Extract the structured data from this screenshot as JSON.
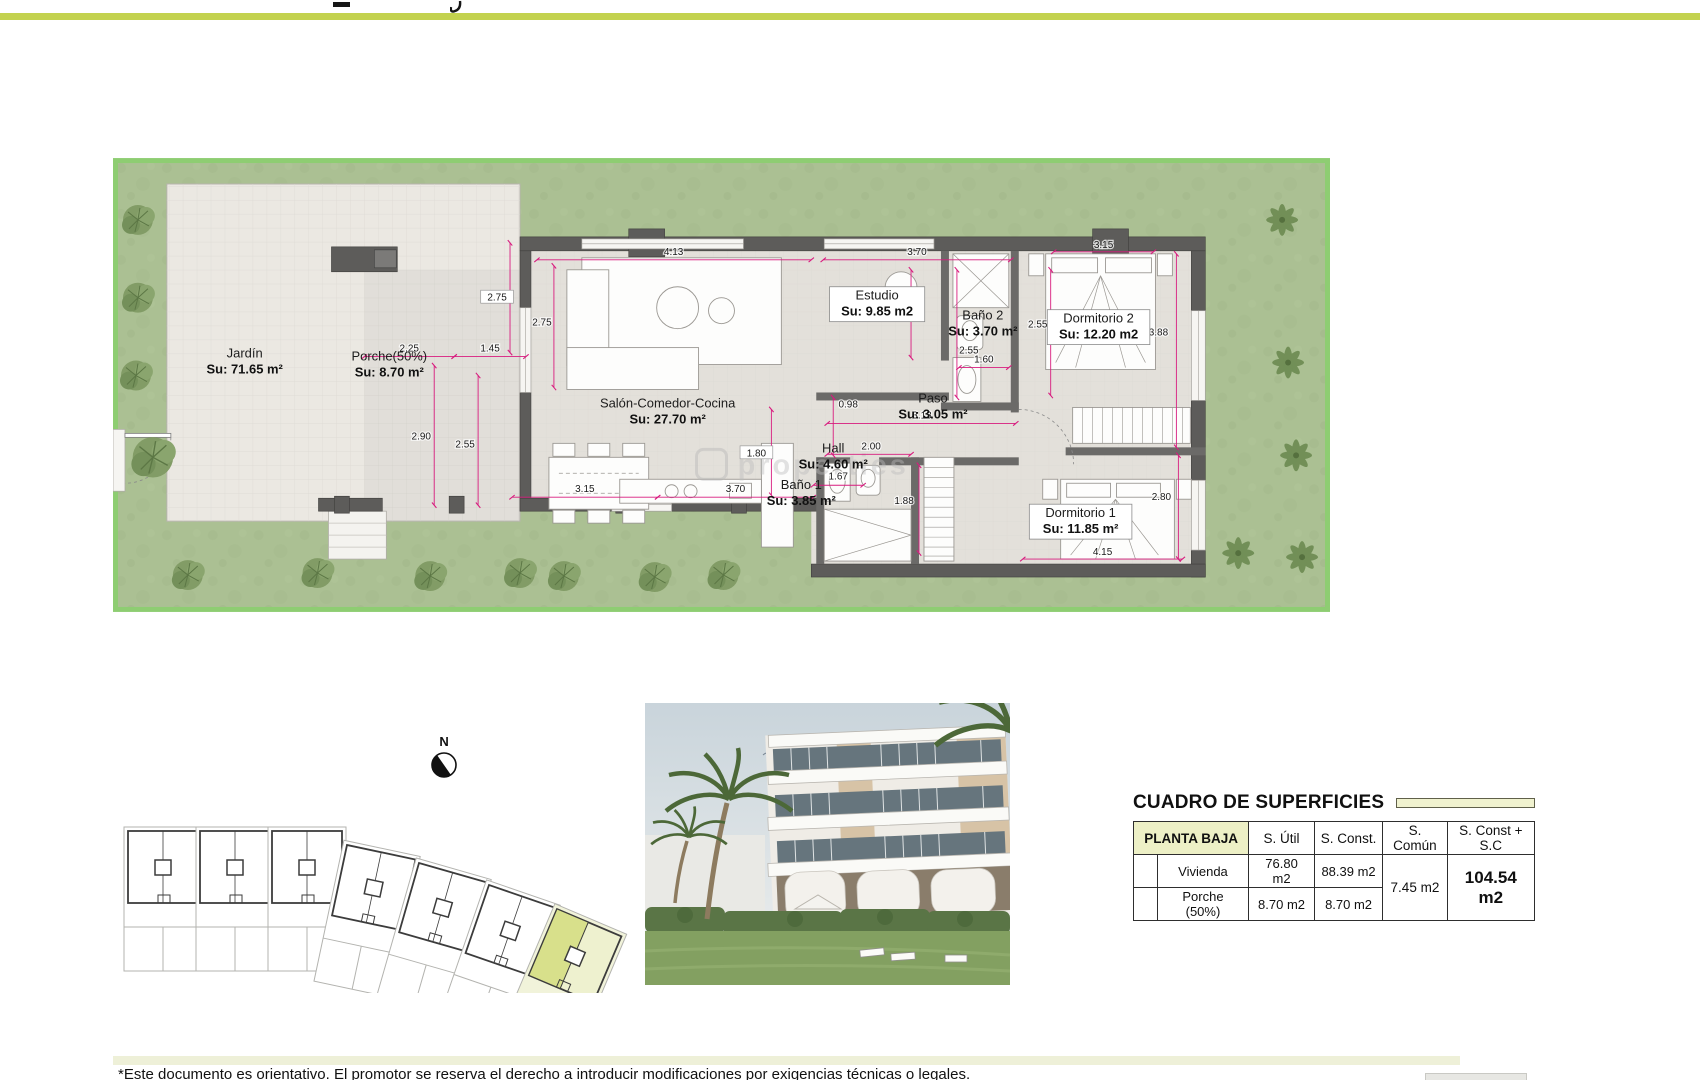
{
  "page": {
    "disclaimer": "*Este documento es orientativo. El promotor se reserva el derecho a introducir modificaciones por exigencias técnicas o legales.",
    "accent_color": "#c3d24f"
  },
  "floor_plan": {
    "watermark": "properties",
    "colors": {
      "garden": "#abc093",
      "garden_border": "#8ecd72",
      "paving": "#ebe8e2",
      "interior": "#e3e0da",
      "wall": "#5d5c5a",
      "dimension": "#d81b7e"
    },
    "rooms": [
      {
        "name": "Jardín",
        "area": "Su: 71.65 m²",
        "x": 132,
        "y": 200,
        "boxed": false
      },
      {
        "name": "Porche(50%)",
        "area": "Su: 8.70 m²",
        "x": 277,
        "y": 203,
        "boxed": false
      },
      {
        "name": "Salón-Comedor-Cocina",
        "area": "Su: 27.70 m²",
        "x": 556,
        "y": 250,
        "boxed": false
      },
      {
        "name": "Estudio",
        "area": "Su: 9.85 m2",
        "x": 766,
        "y": 142,
        "boxed": true
      },
      {
        "name": "Baño 2",
        "area": "Su: 3.70 m²",
        "x": 872,
        "y": 162,
        "boxed": false
      },
      {
        "name": "Dormitorio 2",
        "area": "Su: 12.20 m2",
        "x": 988,
        "y": 165,
        "boxed": true
      },
      {
        "name": "Paso",
        "area": "Su: 3.05 m²",
        "x": 822,
        "y": 245,
        "boxed": false
      },
      {
        "name": "Hall",
        "area": "Su: 4.60 m²",
        "x": 722,
        "y": 295,
        "boxed": false
      },
      {
        "name": "Baño 1",
        "area": "Su: 3.85 m²",
        "x": 690,
        "y": 332,
        "boxed": false
      },
      {
        "name": "Dormitorio 1",
        "area": "Su: 11.85 m²",
        "x": 970,
        "y": 360,
        "boxed": true
      }
    ],
    "dimensions": [
      {
        "label": "4.13",
        "x1": 425,
        "y1": 102,
        "x2": 700,
        "y2": 102,
        "lx": 562,
        "ly": 97
      },
      {
        "label": "3.70",
        "x1": 712,
        "y1": 102,
        "x2": 900,
        "y2": 102,
        "lx": 806,
        "ly": 97
      },
      {
        "label": "2.75",
        "x1": 398,
        "y1": 85,
        "x2": 398,
        "y2": 195,
        "lx": 385,
        "ly": 143,
        "boxed": true
      },
      {
        "label": "2.75",
        "x1": 442,
        "y1": 108,
        "x2": 442,
        "y2": 230,
        "lx": 430,
        "ly": 168
      },
      {
        "label": "2.25",
        "x1": 252,
        "y1": 199,
        "x2": 342,
        "y2": 199,
        "lx": 297,
        "ly": 194
      },
      {
        "label": "1.45",
        "x1": 342,
        "y1": 199,
        "x2": 414,
        "y2": 199,
        "lx": 378,
        "ly": 194
      },
      {
        "label": "2.90",
        "x1": 322,
        "y1": 208,
        "x2": 322,
        "y2": 348,
        "lx": 309,
        "ly": 282
      },
      {
        "label": "2.55",
        "x1": 366,
        "y1": 218,
        "x2": 366,
        "y2": 348,
        "lx": 353,
        "ly": 290
      },
      {
        "label": "3.15",
        "x1": 400,
        "y1": 340,
        "x2": 546,
        "y2": 340,
        "lx": 473,
        "ly": 335
      },
      {
        "label": "3.70",
        "x1": 546,
        "y1": 340,
        "x2": 702,
        "y2": 340,
        "lx": 624,
        "ly": 335
      },
      {
        "label": "1.80",
        "x1": 660,
        "y1": 252,
        "x2": 660,
        "y2": 338,
        "lx": 645,
        "ly": 299,
        "boxed": true
      },
      {
        "label": "1.67",
        "x1": 702,
        "y1": 328,
        "x2": 752,
        "y2": 328,
        "lx": 727,
        "ly": 322
      },
      {
        "label": "2.55",
        "x1": 800,
        "y1": 112,
        "x2": 800,
        "y2": 200,
        "lx": 787,
        "ly": 158
      },
      {
        "label": "2.55",
        "x1": 846,
        "y1": 112,
        "x2": 846,
        "y2": 240,
        "lx": 858,
        "ly": 196
      },
      {
        "label": "2.55",
        "x1": 940,
        "y1": 112,
        "x2": 940,
        "y2": 238,
        "lx": 927,
        "ly": 170
      },
      {
        "label": "1.60",
        "x1": 848,
        "y1": 210,
        "x2": 898,
        "y2": 210,
        "lx": 873,
        "ly": 205
      },
      {
        "label": "3.15",
        "x1": 943,
        "y1": 94,
        "x2": 1043,
        "y2": 94,
        "lx": 993,
        "ly": 90
      },
      {
        "label": "3.88",
        "x1": 1066,
        "y1": 96,
        "x2": 1066,
        "y2": 290,
        "lx": 1048,
        "ly": 178
      },
      {
        "label": "0.98",
        "x1": 722,
        "y1": 240,
        "x2": 722,
        "y2": 298,
        "lx": 737,
        "ly": 250
      },
      {
        "label": "3.13",
        "x1": 716,
        "y1": 266,
        "x2": 905,
        "y2": 266,
        "lx": 811,
        "ly": 261
      },
      {
        "label": "2.00",
        "x1": 716,
        "y1": 297,
        "x2": 800,
        "y2": 297,
        "lx": 760,
        "ly": 292
      },
      {
        "label": "1.88",
        "x1": 808,
        "y1": 308,
        "x2": 808,
        "y2": 396,
        "lx": 793,
        "ly": 347
      },
      {
        "label": "4.15",
        "x1": 912,
        "y1": 402,
        "x2": 1072,
        "y2": 402,
        "lx": 992,
        "ly": 398
      },
      {
        "label": "2.80",
        "x1": 1068,
        "y1": 298,
        "x2": 1068,
        "y2": 402,
        "lx": 1051,
        "ly": 343
      }
    ]
  },
  "site_plan": {
    "north_label": "N",
    "highlight_color": "#d8e08b",
    "buildings": [
      {
        "x": 33,
        "y": 98,
        "r": 0,
        "hl": false
      },
      {
        "x": 105,
        "y": 98,
        "r": 0,
        "hl": false
      },
      {
        "x": 177,
        "y": 98,
        "r": 0,
        "hl": false
      },
      {
        "x": 252,
        "y": 112,
        "r": 12,
        "hl": false
      },
      {
        "x": 324,
        "y": 130,
        "r": 16,
        "hl": false
      },
      {
        "x": 394,
        "y": 152,
        "r": 19,
        "hl": false
      },
      {
        "x": 462,
        "y": 176,
        "r": 23,
        "hl": true
      }
    ]
  },
  "surfaces_table": {
    "title": "CUADRO DE SUPERFICIES",
    "columns": [
      "PLANTA BAJA",
      "S. Útil",
      "S. Const.",
      "S. Común",
      "S. Const + S.C"
    ],
    "rows": [
      {
        "label": "Vivienda",
        "s_util": "76.80 m2",
        "s_const": "88.39 m2"
      },
      {
        "label": "Porche (50%)",
        "s_util": "8.70 m2",
        "s_const": "8.70 m2"
      }
    ],
    "s_comun": "7.45 m2",
    "s_const_sc": "104.54 m2"
  }
}
